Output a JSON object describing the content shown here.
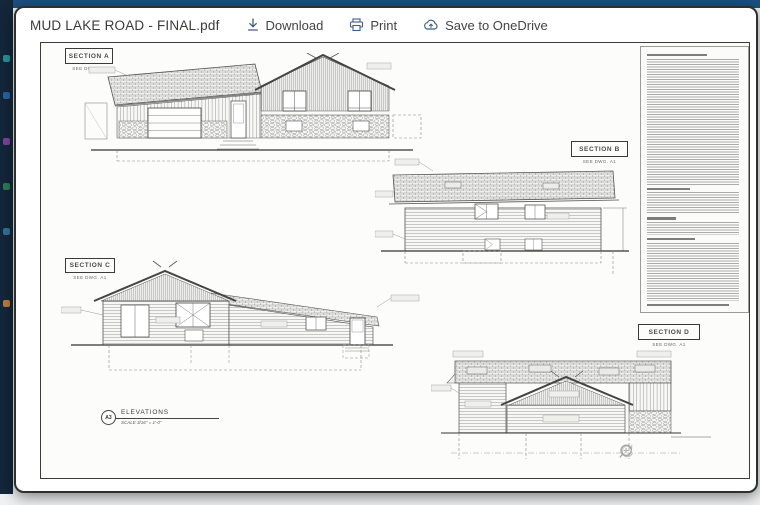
{
  "window": {
    "title": "MUD LAKE ROAD - FINAL.pdf"
  },
  "toolbar": {
    "download_label": "Download",
    "print_label": "Print",
    "save_label": "Save to OneDrive",
    "icons": {
      "download": "arrow-down-to-line",
      "print": "printer",
      "save": "cloud-sync"
    }
  },
  "sheet": {
    "sections": [
      {
        "label": "SECTION A",
        "sub": "SEE DWG. A1"
      },
      {
        "label": "SECTION B",
        "sub": "SEE DWG. A1"
      },
      {
        "label": "SECTION C",
        "sub": "SEE DWG. A1"
      },
      {
        "label": "SECTION D",
        "sub": "SEE DWG. A1"
      }
    ],
    "titleblock": {
      "sheet_ref": "A3",
      "title": "ELEVATIONS",
      "scale": "SCALE 3/16\" = 1'-0\""
    },
    "notes_panel": {
      "legible_text": ""
    }
  },
  "viewer_controls": {
    "icons": [
      "zoom-in",
      "zoom-out",
      "search",
      "rotate"
    ]
  },
  "colors": {
    "topbar": "#1b4f7e",
    "appbar": "#142639",
    "toolbar_icon": "#3e5f82",
    "toolbar_text": "#444444",
    "drawing_line": "#444444",
    "sheet_bg": "#fcfcfb"
  }
}
